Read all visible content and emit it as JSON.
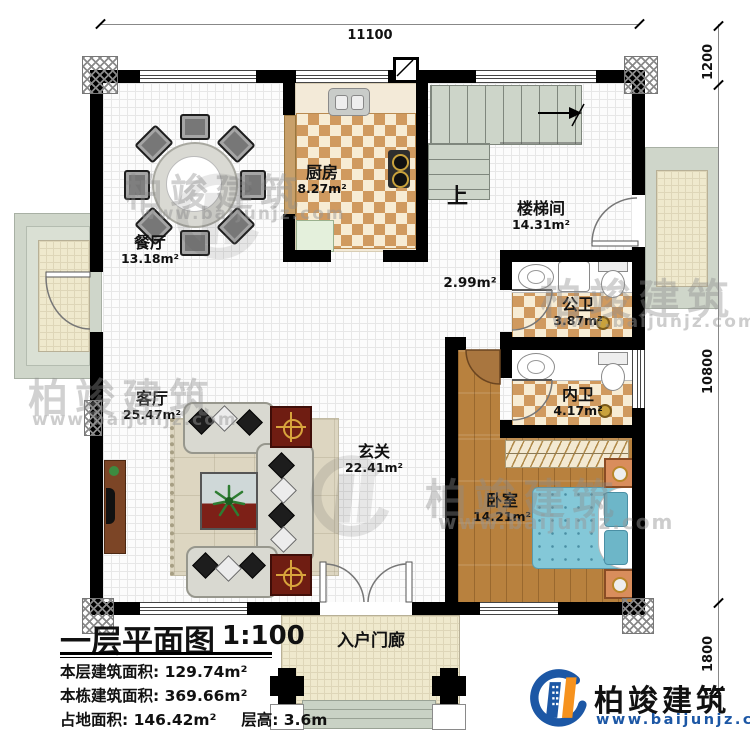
{
  "plan": {
    "title": "一层平面图",
    "scale": "1:100",
    "stats": [
      {
        "label": "本层建筑面积:",
        "value": "129.74m²"
      },
      {
        "label": "本栋建筑面积:",
        "value": "369.66m²"
      },
      {
        "label": "占地面积:",
        "value": "146.42m²"
      },
      {
        "label": "层高:",
        "value": "3.6m"
      }
    ]
  },
  "rooms": {
    "dining": {
      "name": "餐厅",
      "area": "13.18m²"
    },
    "kitchen": {
      "name": "厨房",
      "area": "8.27m²"
    },
    "stairwell": {
      "name": "楼梯间",
      "area": "14.31m²"
    },
    "hallway": {
      "area": "2.99m²"
    },
    "public_bath": {
      "name": "公卫",
      "area": "3.87m²"
    },
    "private_bath": {
      "name": "内卫",
      "area": "4.17m²"
    },
    "living": {
      "name": "客厅",
      "area": "25.47m²"
    },
    "foyer": {
      "name": "玄关",
      "area": "22.41m²"
    },
    "bedroom": {
      "name": "卧室",
      "area": "14.21m²"
    },
    "porch": {
      "name": "入户门廊"
    }
  },
  "stairs": {
    "up_label": "上"
  },
  "dimensions": {
    "top": "11100",
    "right_top": "1200",
    "right_middle": "10800",
    "right_bottom": "1800"
  },
  "branding": {
    "company": "柏竣建筑",
    "website": "www.baijunjz.com"
  },
  "watermark": {
    "text": "柏竣建筑",
    "site": "www.baijunjz.com"
  },
  "colors": {
    "checker_tan": "#d09a5f",
    "wood": "#b8813e",
    "bed_blue": "#84c8d8",
    "stair_green": "#cdd5c9",
    "terrace_green": "#cfd6ca",
    "logo_blue": "#1c57a5",
    "logo_orange": "#f6921e"
  }
}
